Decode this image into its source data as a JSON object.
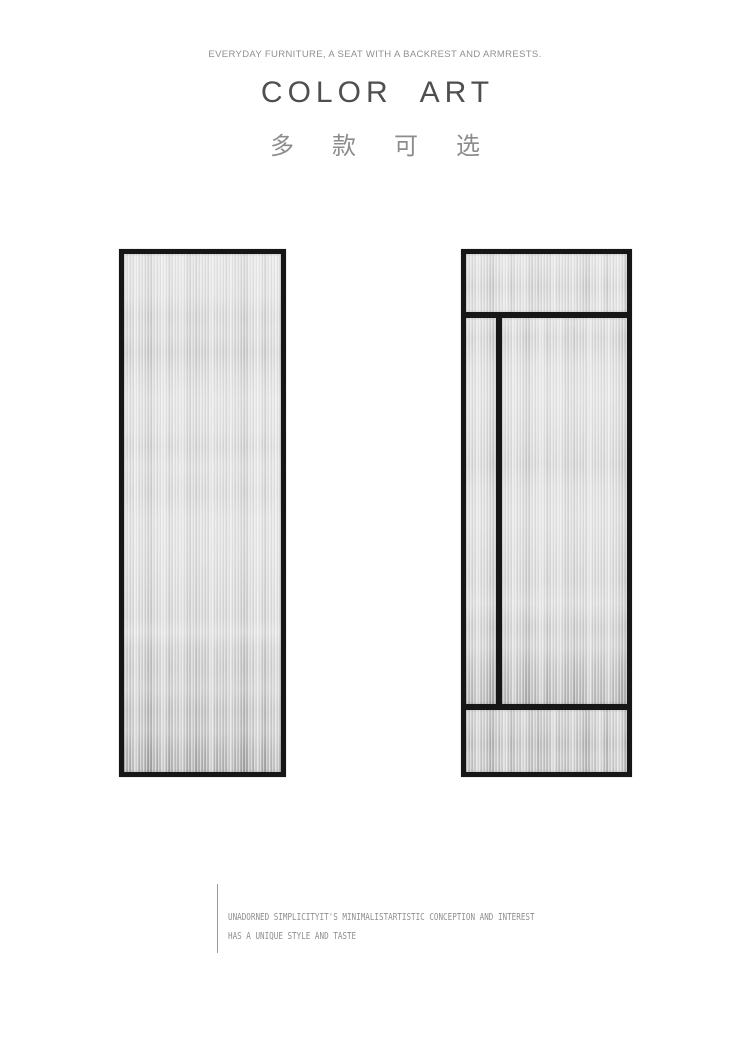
{
  "header": {
    "tagline": "EVERYDAY FURNITURE, A SEAT WITH A BACKREST AND ARMRESTS.",
    "title_word1": "COLOR",
    "title_word2": "ART",
    "subtitle_cn": "多款可选"
  },
  "panels": {
    "left_label": "single-pane fluted glass panel",
    "right_label": "divided fluted glass panel"
  },
  "footer": {
    "line1": "UNADORNED SIMPLICITYIT'S MINIMALISTARTISTIC CONCEPTION AND INTEREST",
    "line2": "HAS A UNIQUE STYLE AND TASTE"
  },
  "colors": {
    "page_bg": "#ffffff",
    "frame": "#161616",
    "title_text": "#4f4f4f",
    "tagline_text": "#909090",
    "subtitle_text": "#8c8c8c",
    "footer_text": "#8f8f8f",
    "accent_line": "#9a9a9a"
  }
}
